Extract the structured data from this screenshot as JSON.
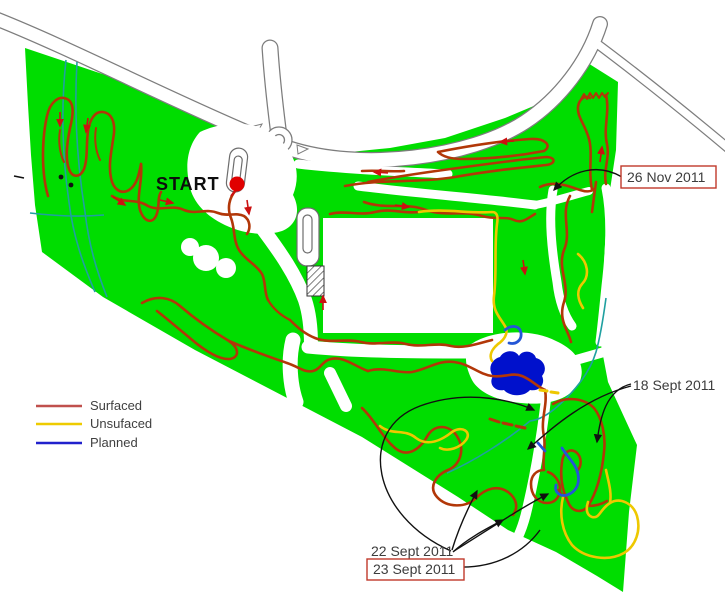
{
  "map": {
    "start_label": "START",
    "legend": {
      "items": [
        {
          "label": "Surfaced",
          "color": "#c0504d"
        },
        {
          "label": "Unsufaced",
          "color": "#eecb00"
        },
        {
          "label": "Planned",
          "color": "#2121cc"
        }
      ]
    },
    "annotations": {
      "nov26": {
        "text": "26 Nov 2011",
        "boxed": true
      },
      "sept18": {
        "text": "18 Sept 2011",
        "boxed": false
      },
      "sept22": {
        "text": "22 Sept 2011",
        "boxed": false
      },
      "sept23": {
        "text": "23 Sept 2011",
        "boxed": true
      }
    },
    "colors": {
      "land": "#00dd00",
      "surfaced_trail": "#b23708",
      "unsurfaced_trail": "#eec800",
      "planned_trail": "#2456d6",
      "water": "#0011cc",
      "stream": "#1fa0a0",
      "annotation_box": "#c0392b",
      "start_dot": "#e00000"
    }
  }
}
